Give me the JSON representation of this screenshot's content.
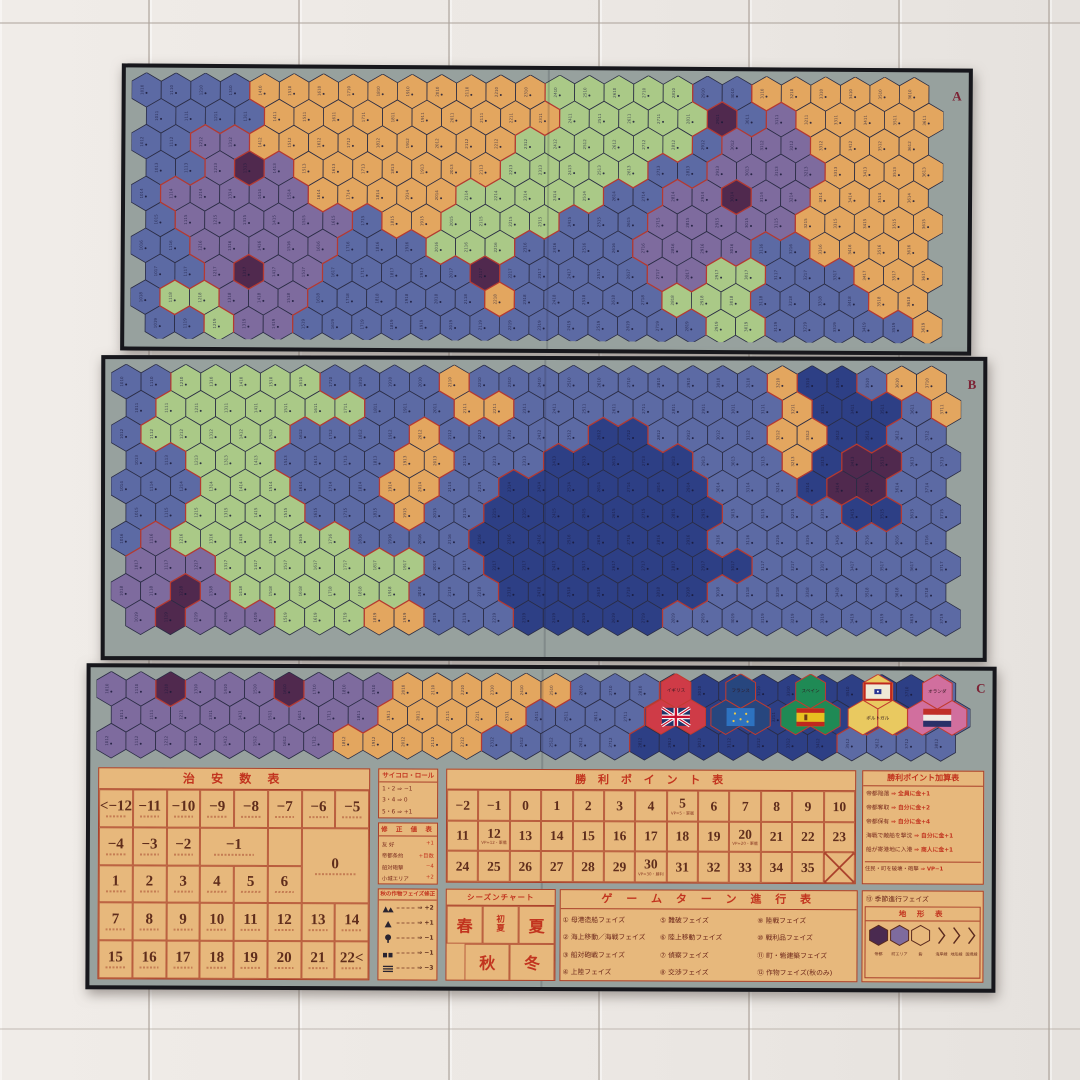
{
  "scene": {
    "description_floor": "light wooden floor",
    "board_letters": [
      "A",
      "B",
      "C"
    ]
  },
  "palette": {
    "hex": {
      "B": "#5c6aa4",
      "N": "#2d3f85",
      "O": "#e3a65f",
      "G": "#aac987",
      "P": "#7e6b9e",
      "M": "#50294e"
    },
    "sea": "#5c6aa4",
    "deep_sea": "#2d3f85",
    "land_orange": "#e3a65f",
    "land_green": "#aac987",
    "land_purple": "#7e6b9e",
    "city_dark": "#50294e",
    "board_margin": "#97a19e",
    "frame": "#17171c",
    "table_bg": "#e7b87c",
    "table_line": "#a93f2a",
    "title_red": "#c2341f",
    "number_brown": "#5f2d1c",
    "region_border_red": "#c23b2f",
    "hex_grid_stroke": "#2a2c44"
  },
  "panels": [
    {
      "label": "A",
      "rows": [
        "BBBBOOOOOOOOOOGGGGGBBOOOOOO",
        "BBBBOOOOOOOOOOGGGGGMBPOOOOO",
        "BBPPOOOOOOOOOGGGGGGBPPPOOOO",
        "BBPMPOOOOOOOGGGGGBBPPPPOOOO",
        "BPPPPPOOOOOGGGGGBBPPMPPOOOO",
        "BPPPPPPBOOGGGGBBBPPPPPOOOOO",
        "BBPPPPPBBBGGGBBBBPPPPBBOOOO",
        "BBPMPPBBBBBMBBBBBPPGGBBBOOO",
        "BGGPPPBBBBBBOBBBBBGGGBBBBOO",
        "BBGPPBBBBBBBBBBBBBBGGBBBBBO"
      ]
    },
    {
      "label": "B",
      "rows": [
        "BBGGGGGBBBBOBBBBBBBBBBONNBOO",
        "BGGGGGGGBBBOOBBBBBBBBBONNNBO",
        "BGGGGGBBBBOBBBBBNNBBBBOONNBB",
        "BBGGGBBBBOOBBBNNNNNBBBONMMBB",
        "BBBGGGBBBOOBBNNNNNNNBBBNMMBB",
        "BBGGGGBBBOBBNNNNNNNNBBBBNNBB",
        "BPGGGGGGBBBBNNNNNNNNBBBBBBBB",
        "PPPGGGGGGGBBNNNNNNNNNBBBBBBB",
        "PPMPGGGGGGBBBNNNNNNNBBBBBBBB",
        "PMPPPGGGOOBBBNNNNNBBBBBBBBBB"
      ]
    },
    {
      "label": "C",
      "rows": [
        "PPMPPPMPPPOOOOOOBBBNNNNNNNNNB",
        "PPPPPPPPPOOOOOBBBBNNNNNNNNNBB",
        "PPPPPPPPOOOOOBBBBBNNNNNNNBBBB"
      ]
    }
  ],
  "flags": [
    {
      "name": "イギリス",
      "cluster_color": "#cf3b47",
      "flag": "uk",
      "label_pos": "top",
      "cx_frac": 0.663
    },
    {
      "name": "フランス",
      "cluster_color": "#27467e",
      "flag": "france",
      "label_pos": "top",
      "cx_frac": 0.737
    },
    {
      "name": "スペイン",
      "cluster_color": "#1f8a55",
      "flag": "spain",
      "label_pos": "top",
      "cx_frac": 0.817
    },
    {
      "name": "ポルトガル",
      "cluster_color": "#e9c960",
      "flag": "portugal",
      "label_pos": "bottom",
      "cx_frac": 0.894
    },
    {
      "name": "オランダ",
      "cluster_color": "#d16f9e",
      "flag": "netherlands",
      "label_pos": "top",
      "cx_frac": 0.962
    }
  ],
  "tables": {
    "security": {
      "title": "治 安 数 表",
      "rows": [
        [
          {
            "t": "<−12"
          },
          {
            "t": "−11"
          },
          {
            "t": "−10"
          },
          {
            "t": "−9"
          },
          {
            "t": "−8"
          },
          {
            "t": "−7"
          },
          {
            "t": "−6"
          },
          {
            "t": "−5"
          }
        ],
        [
          {
            "t": "−4"
          },
          {
            "t": "−3"
          },
          {
            "t": "−2"
          },
          {
            "t": "−1",
            "cs": 2
          },
          {
            "t": "",
            "cs": 1
          },
          {
            "t": "0",
            "cs": 2,
            "rs": 2
          }
        ],
        [
          {
            "t": "1"
          },
          {
            "t": "2"
          },
          {
            "t": "3"
          },
          {
            "t": "4"
          },
          {
            "t": "5"
          },
          {
            "t": "6"
          }
        ],
        [
          {
            "t": "7"
          },
          {
            "t": "8"
          },
          {
            "t": "9"
          },
          {
            "t": "10"
          },
          {
            "t": "11"
          },
          {
            "t": "12"
          },
          {
            "t": "13"
          },
          {
            "t": "14"
          }
        ],
        [
          {
            "t": "15"
          },
          {
            "t": "16"
          },
          {
            "t": "17"
          },
          {
            "t": "18"
          },
          {
            "t": "19"
          },
          {
            "t": "20"
          },
          {
            "t": "21"
          },
          {
            "t": "22<"
          }
        ]
      ]
    },
    "dice": {
      "title": "サイコロ・ロール",
      "lines": [
        "1・2 ⇒ −1",
        "3・4 ⇒ 0",
        "5・6 ⇒ +1"
      ]
    },
    "modifier": {
      "title": "修 正 値 表",
      "rows": [
        [
          "友 好",
          "+1"
        ],
        [
          "帝都条約",
          "+目数"
        ],
        [
          "船対砲撃",
          "−4"
        ],
        [
          "小城エリア",
          "+2"
        ]
      ]
    },
    "autumn": {
      "title": "秋の作物フェイズ修正",
      "items": [
        {
          "icon": "mountain2",
          "mod": "+2"
        },
        {
          "icon": "mountain1",
          "mod": "+1"
        },
        {
          "icon": "tree",
          "mod": "−1"
        },
        {
          "icon": "village",
          "mod": "−1"
        },
        {
          "icon": "field",
          "mod": "−3"
        }
      ]
    },
    "season": {
      "title": "シーズンチャート",
      "row1": [
        "春",
        "初夏",
        "夏"
      ],
      "row2": [
        "秋",
        "冬"
      ]
    },
    "vp": {
      "title": "勝 利 ポ イ ン ト 表",
      "rows": [
        [
          "−2",
          "−1",
          "0",
          "1",
          "2",
          "3",
          "4",
          "5",
          "6",
          "7",
          "8",
          "9",
          "10"
        ],
        [
          "11",
          "12",
          "13",
          "14",
          "15",
          "16",
          "17",
          "18",
          "19",
          "20",
          "21",
          "22",
          "23"
        ],
        [
          "24",
          "25",
          "26",
          "27",
          "28",
          "29",
          "30",
          "31",
          "32",
          "33",
          "34",
          "35",
          "X"
        ]
      ],
      "notes": [
        {
          "row": 0,
          "col": 7,
          "text": "VP=5・軍艦"
        },
        {
          "row": 1,
          "col": 1,
          "text": "VP=12・軍艦"
        },
        {
          "row": 1,
          "col": 9,
          "text": "VP=20・軍艦"
        },
        {
          "row": 2,
          "col": 6,
          "text": "VP=30・勝利"
        }
      ]
    },
    "vp_add": {
      "title": "勝利ポイント加算表",
      "lines": [
        "帝都陥落 ⇒ 全員に金+1",
        "帝都奪取 ⇒ 自分に金+2",
        "帝都保有 ⇒ 自分に金+4",
        "海戦で敵船を撃沈 ⇒ 自分に金+1",
        "船が寄港地に入港 ⇒ 商人に金+1"
      ],
      "footer": "住民・町を破壊・砲撃 ⇒ VP−1"
    },
    "turn": {
      "title": "ゲ ー ム タ ー ン 進 行 表",
      "phases": [
        "① 母港造船フェイズ",
        "② 海上移動／海戦フェイズ",
        "③ 船対砲戦フェイズ",
        "④ 上陸フェイズ",
        "⑤ 難破フェイズ",
        "⑥ 陸上移動フェイズ",
        "⑦ 偵察フェイズ",
        "⑧ 交渉フェイズ",
        "⑨ 陸戦フェイズ",
        "⑩ 戦利品フェイズ",
        "⑪ 町・砦建築フェイズ",
        "⑫ 作物フェイズ(秋のみ)"
      ],
      "phase13": "⑬ 季節進行フェイズ"
    },
    "terrain": {
      "title": "地 形 表",
      "items": [
        {
          "shape": "hex-dark",
          "label": "帝都"
        },
        {
          "shape": "hex-mid",
          "label": "町エリア"
        },
        {
          "shape": "hex-outline",
          "label": "砦"
        },
        {
          "shape": "chevron",
          "label": "海岸線"
        },
        {
          "shape": "chevron",
          "label": "地形線"
        },
        {
          "shape": "chevron",
          "label": "国境線"
        }
      ]
    }
  }
}
